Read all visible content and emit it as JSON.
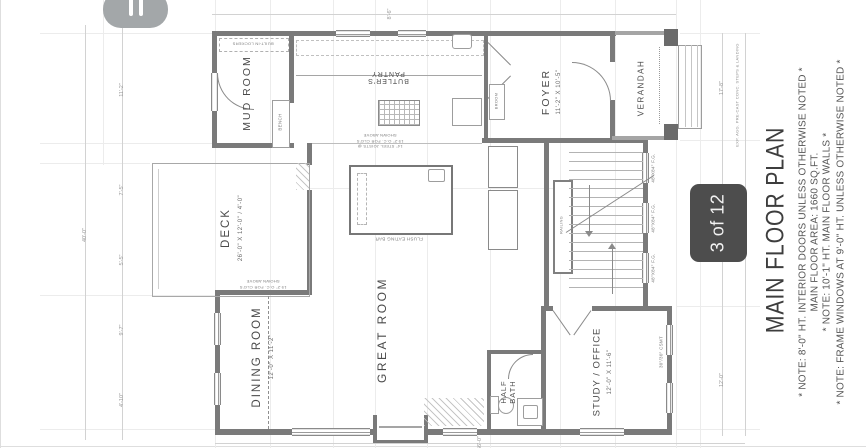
{
  "viewer": {
    "page_indicator": "3 of 12"
  },
  "title_block": {
    "title": "MAIN FLOOR PLAN",
    "notes": [
      "* NOTE: 8'-0\" HT. INTERIOR DOORS UNLESS OTHERWISE NOTED *",
      "MAIN FLOOR AREA: 1660 SQ.FT.",
      "* NOTE: 10'-1\" HT. MAIN FLOOR WALLS *",
      "* NOTE: FRAME WINDOWS AT 9'-0\" HT. UNLESS OTHERWISE NOTED *"
    ]
  },
  "rooms": {
    "deck": {
      "label": "DECK",
      "dim": "26'-0\" X 12'-0\" / 4'-0\""
    },
    "mud_room": {
      "label": "MUD ROOM"
    },
    "butlers_pantry": {
      "label": "BUTLER'S PANTRY"
    },
    "foyer": {
      "label": "FOYER",
      "dim": "11'-2\" X 10'-5\""
    },
    "verandah": {
      "label": "VERANDAH"
    },
    "dining_room": {
      "label": "DINING ROOM",
      "dim": "12'-0\" X 11'-2\""
    },
    "great_room": {
      "label": "GREAT ROOM"
    },
    "study": {
      "label": "STUDY / OFFICE",
      "dim": "12'-0\" X 11'-6\""
    },
    "half_bath": {
      "label": "HALF BATH"
    }
  },
  "annotations": {
    "built_in_lockers": "BUILT-IN LOCKERS",
    "bench": "BENCH",
    "broom": "BROOM",
    "railing": "RAILING",
    "flush_eating_bar": "FLUSH EATING BAR",
    "joists_note": "14\" STEEL JOISTS @ 19.2\" O.C. FOR CLG'S SHOWN ABOVE",
    "steps_note": "EXP. AGG. PRE-CAST CONC. STEPS & LANDING"
  },
  "window_labels": [
    "48\"X84\" F.G.",
    "48\"X84\" F.G.",
    "48\"X84\" F.G.",
    "30\"/30\" CSMT"
  ],
  "dim_labels": {
    "overall_left": "40'-0\"",
    "left": [
      "11'-2\"",
      "7'-5\"",
      "5'-5\"",
      "9'-7\"",
      "4'-10\""
    ],
    "top": "8'-6\"",
    "right_top": "17'-8\"",
    "right_bottom": "12'-0\"",
    "bottom": "56'-0\""
  },
  "colors": {
    "wall": "#7a7a7a",
    "badge": "#4d4d4d",
    "pill": "#a3a7a9",
    "dim_line": "#d2d2d2"
  }
}
